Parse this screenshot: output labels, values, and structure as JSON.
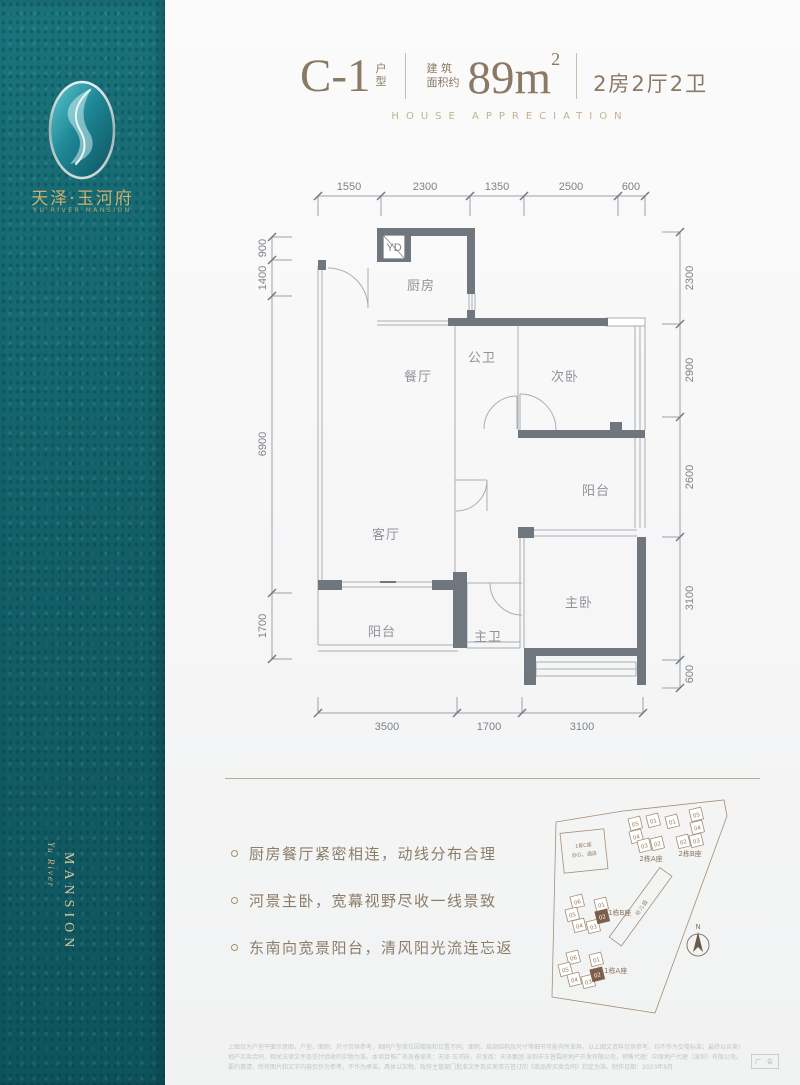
{
  "brand": {
    "name_cn": "天泽·玉河府",
    "name_en": "YU RIVER MANSION",
    "vertical_script": "Yu River",
    "vertical_word": "MANSION"
  },
  "header": {
    "unit_code": "C-1",
    "unit_type": "户型",
    "area_label_line1": "建 筑",
    "area_label_line2": "面积约",
    "area_value": "89m",
    "area_exponent": "2",
    "layout_text": "2房2厅2卫",
    "subtitle": "HOUSE APPRECIATION"
  },
  "floor_plan": {
    "flue_label": "YD",
    "rooms": [
      "厨房",
      "公卫",
      "次卧",
      "餐厅",
      "阳台",
      "客厅",
      "主卧",
      "主卫",
      "阳台"
    ],
    "dims_top": [
      "1550",
      "2300",
      "1350",
      "2500",
      "600"
    ],
    "dims_left": [
      "900",
      "1400",
      "6900",
      "1700"
    ],
    "dims_right": [
      "2300",
      "2900",
      "2600",
      "3100",
      "600"
    ],
    "dims_bottom": [
      "3500",
      "1700",
      "3100"
    ]
  },
  "features": [
    "厨房餐厅紧密相连，动线分布合理",
    "河景主卧，宽幕视野尽收一线景致",
    "东南向宽景阳台，清风阳光流连忘返"
  ],
  "site_plan": {
    "building_c_line1": "1栋C座",
    "building_c_line2": "办公、酒店",
    "block_2a_label": "2栋A座",
    "block_2a_units": [
      "05",
      "04",
      "01",
      "03",
      "02"
    ],
    "block_2b_label": "2栋B座",
    "block_2b_units": [
      "01",
      "05",
      "04",
      "02",
      "03"
    ],
    "block_1b_label": "1栋B座",
    "block_1b_units": [
      "06",
      "01",
      "05",
      "04",
      "03",
      "02"
    ],
    "block_1a_label": "1栋A座",
    "block_1a_units": [
      "06",
      "01",
      "05",
      "04",
      "03",
      "02"
    ],
    "kindergarten": "幼儿园",
    "compass": "N"
  },
  "footer": {
    "disclaimer_line1": "上图仅为户型平面示意图，户型、面积、尺寸仅供参考，相同户型单位因楼层和位置不同，面积、局部结构及尺寸等细节可能有所差异。以上图文资料仅供参考，均不作为交楼标准；最终以买卖双方签订的房",
    "disclaimer_line2": "地产买卖合同、相关法律文件及交付验收的实物为准。本项目推广名及备案名：天泽·玉河府，开发商：天泽集团 深圳市玉普霖房地产开发有限公司，销售代理：中原地产代理（深圳）有限公司。本广告作为",
    "disclaimer_line3": "要约邀请，所有图片和文字内容仅作为参考，不作为承诺，具体以实物、政府主管部门批准文件及买卖双方签订的《商品房买卖合同》约定为准。制作日期：2023年8月",
    "ad_label": "广 告"
  },
  "colors": {
    "sidebar_teal": "#15666e",
    "accent_gold": "#c9a96a",
    "header_bronze": "#8a7963",
    "wall_gray": "#6f767d",
    "site_brown": "#a68e76",
    "highlight_brown": "#7d5f49"
  }
}
